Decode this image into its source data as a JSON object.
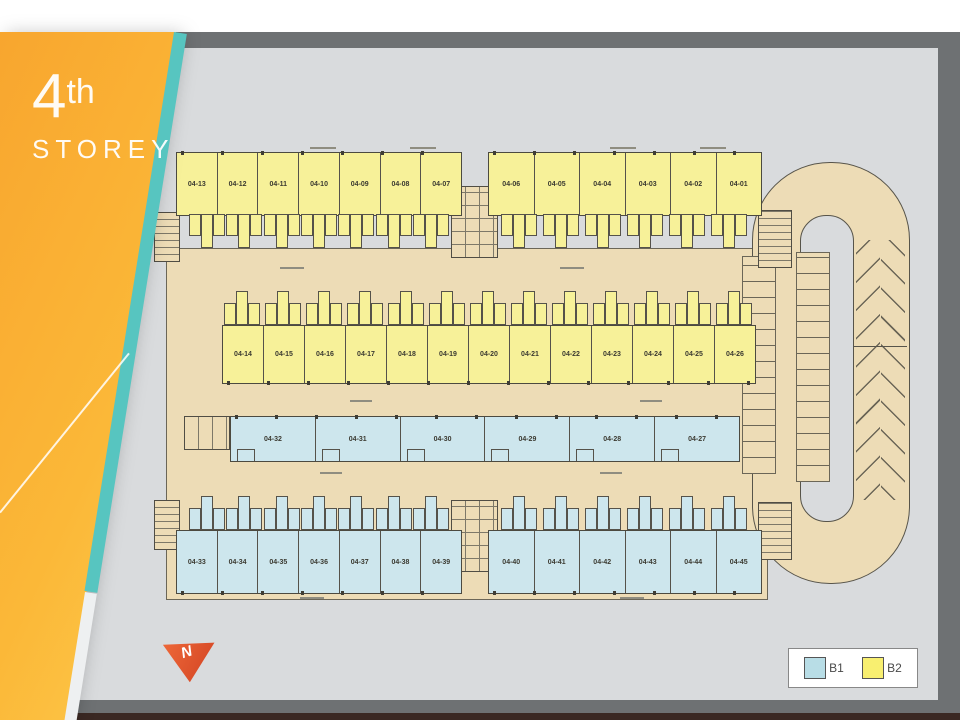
{
  "panel": {
    "storey_number": "4",
    "storey_suffix": "th",
    "storey_label": "STOREY"
  },
  "plan": {
    "rows": [
      {
        "name": "row1-left",
        "type": "B2",
        "units": [
          "04-13",
          "04-12",
          "04-11",
          "04-10",
          "04-09",
          "04-08",
          "04-07"
        ]
      },
      {
        "name": "row1-right",
        "type": "B2",
        "units": [
          "04-06",
          "04-05",
          "04-04",
          "04-03",
          "04-02",
          "04-01"
        ]
      },
      {
        "name": "row2",
        "type": "B2",
        "units": [
          "04-14",
          "04-15",
          "04-16",
          "04-17",
          "04-18",
          "04-19",
          "04-20",
          "04-21",
          "04-22",
          "04-23",
          "04-24",
          "04-25",
          "04-26"
        ]
      },
      {
        "name": "row3",
        "type": "B1",
        "units": [
          "04-32",
          "04-31",
          "04-30",
          "04-29",
          "04-28",
          "04-27"
        ]
      },
      {
        "name": "row4-left",
        "type": "B1",
        "units": [
          "04-33",
          "04-34",
          "04-35",
          "04-36",
          "04-37",
          "04-38",
          "04-39"
        ]
      },
      {
        "name": "row4-right",
        "type": "B1",
        "units": [
          "04-40",
          "04-41",
          "04-42",
          "04-43",
          "04-44",
          "04-45"
        ]
      }
    ]
  },
  "legend": {
    "items": [
      {
        "label": "B1",
        "color": "#b8dde6"
      },
      {
        "label": "B2",
        "color": "#f8ef70"
      }
    ]
  },
  "compass": {
    "letter": "N"
  },
  "colors": {
    "b1_fill": "#cde6ed",
    "b2_fill": "#f7f199",
    "corridor_fill": "#eddcb6",
    "panel_orange": "#f8a52e",
    "accent_teal": "#57c5c0",
    "north_arrow_red": "#e2512c",
    "plan_background": "#d9dbdd",
    "frame_band_gray": "#6e7173",
    "bottom_strip_brown": "#3a2823"
  }
}
